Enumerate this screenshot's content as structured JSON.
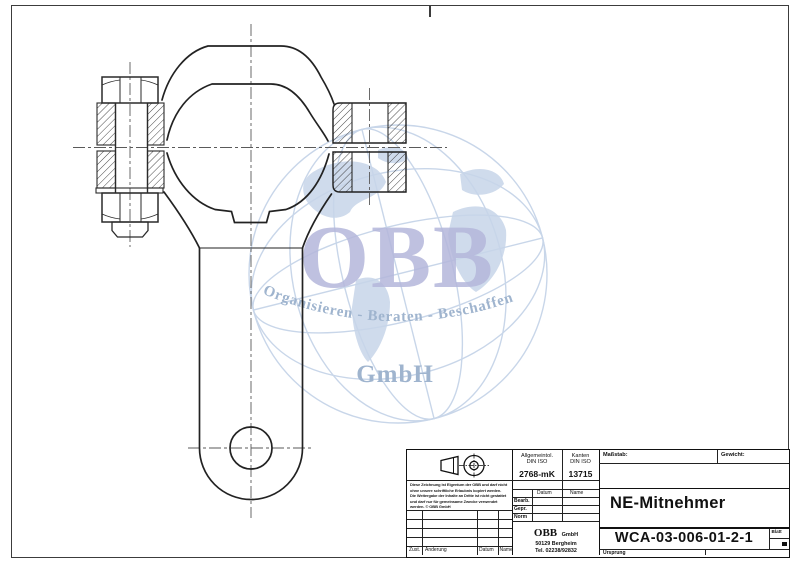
{
  "watermark": {
    "obb": "OBB",
    "tagline": "Organisieren - Beraten - Beschaffen",
    "gmbh": "GmbH",
    "colors": {
      "obb_text": "#b5b7db",
      "tagline_text": "#9fb4ce",
      "globe_lines": "#c6d4e8",
      "continents": "#c7d5e9"
    }
  },
  "title_block": {
    "tolerance": {
      "header1": "Allgemeintol.",
      "header2": "DIN ISO",
      "value": "2768-mK"
    },
    "edges": {
      "header1": "Kanten",
      "header2": "DIN ISO",
      "value": "13715"
    },
    "scale_label": "Maßstab:",
    "weight_label": "Gewicht:",
    "part_title": "NE-Mitnehmer",
    "drawing_number": "WCA-03-006-01-2-1",
    "origin_label": "Ursprung",
    "sheet_label": "Blatt",
    "approval_cols": {
      "datum": "Datum",
      "name": "Name"
    },
    "approval_rows": {
      "r1": "Bearb.",
      "r2": "Gepr.",
      "r3": "Norm"
    },
    "revision_cols": {
      "c1": "Zust.",
      "c2": "Änderung",
      "c3": "Datum",
      "c4": "Name"
    },
    "company": {
      "name": "OBB",
      "suffix": "GmbH",
      "address": "50129 Bergheim",
      "phone": "Tel. 02238/92832"
    },
    "disclaimer_lines": [
      "Diese Zeichnung ist Eigentum der OBB und darf nicht",
      "ohne unsere schriftliche Erlaubnis kopiert werden.",
      "Die Weitergabe der Inhalte an Dritte ist nicht gestattet",
      "und darf nur für gemeinsame Zwecke verwendet",
      "werden. © OBB GmbH"
    ]
  }
}
